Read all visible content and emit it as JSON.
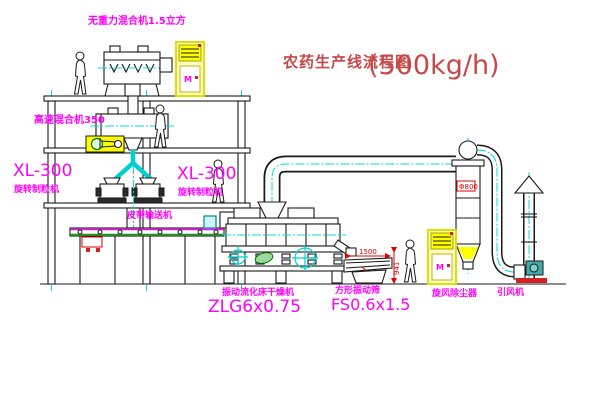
{
  "title": {
    "text": "农药生产线流程图",
    "capacity": "(500kg/h)"
  },
  "labels": {
    "gravity_mixer": "无重力混合机1.5立方",
    "high_speed_mixer": "高速混合机350",
    "granulator_left_model": "XL-300",
    "granulator_left_name": "旋转制粒机",
    "granulator_right_model": "XL-300",
    "granulator_right_name": "旋转制粒机",
    "belt_conveyor": "皮带输送机",
    "dryer_name": "振动流化床干燥机",
    "dryer_model": "ZLG6x0.75",
    "screen_name": "方形振动筛",
    "screen_model": "FS0.6x1.5",
    "cyclone_name": "旋风除尘器",
    "fan_name": "引风机"
  },
  "dimensions": {
    "cyclone_diameter": "Φ800",
    "screen_length": "1500",
    "screen_height": "941"
  },
  "cabinet_marking": "M",
  "colors": {
    "label_magenta": "#ff00ff",
    "title_red": "#c84848",
    "dimension_red": "#e00000",
    "line_black": "#1a1a1a",
    "centerline_cyan": "#00dede",
    "equipment_yellow": "#ffff00",
    "motor_green": "#007700",
    "fan_teal": "#44aaaa",
    "background": "#ffffff"
  }
}
